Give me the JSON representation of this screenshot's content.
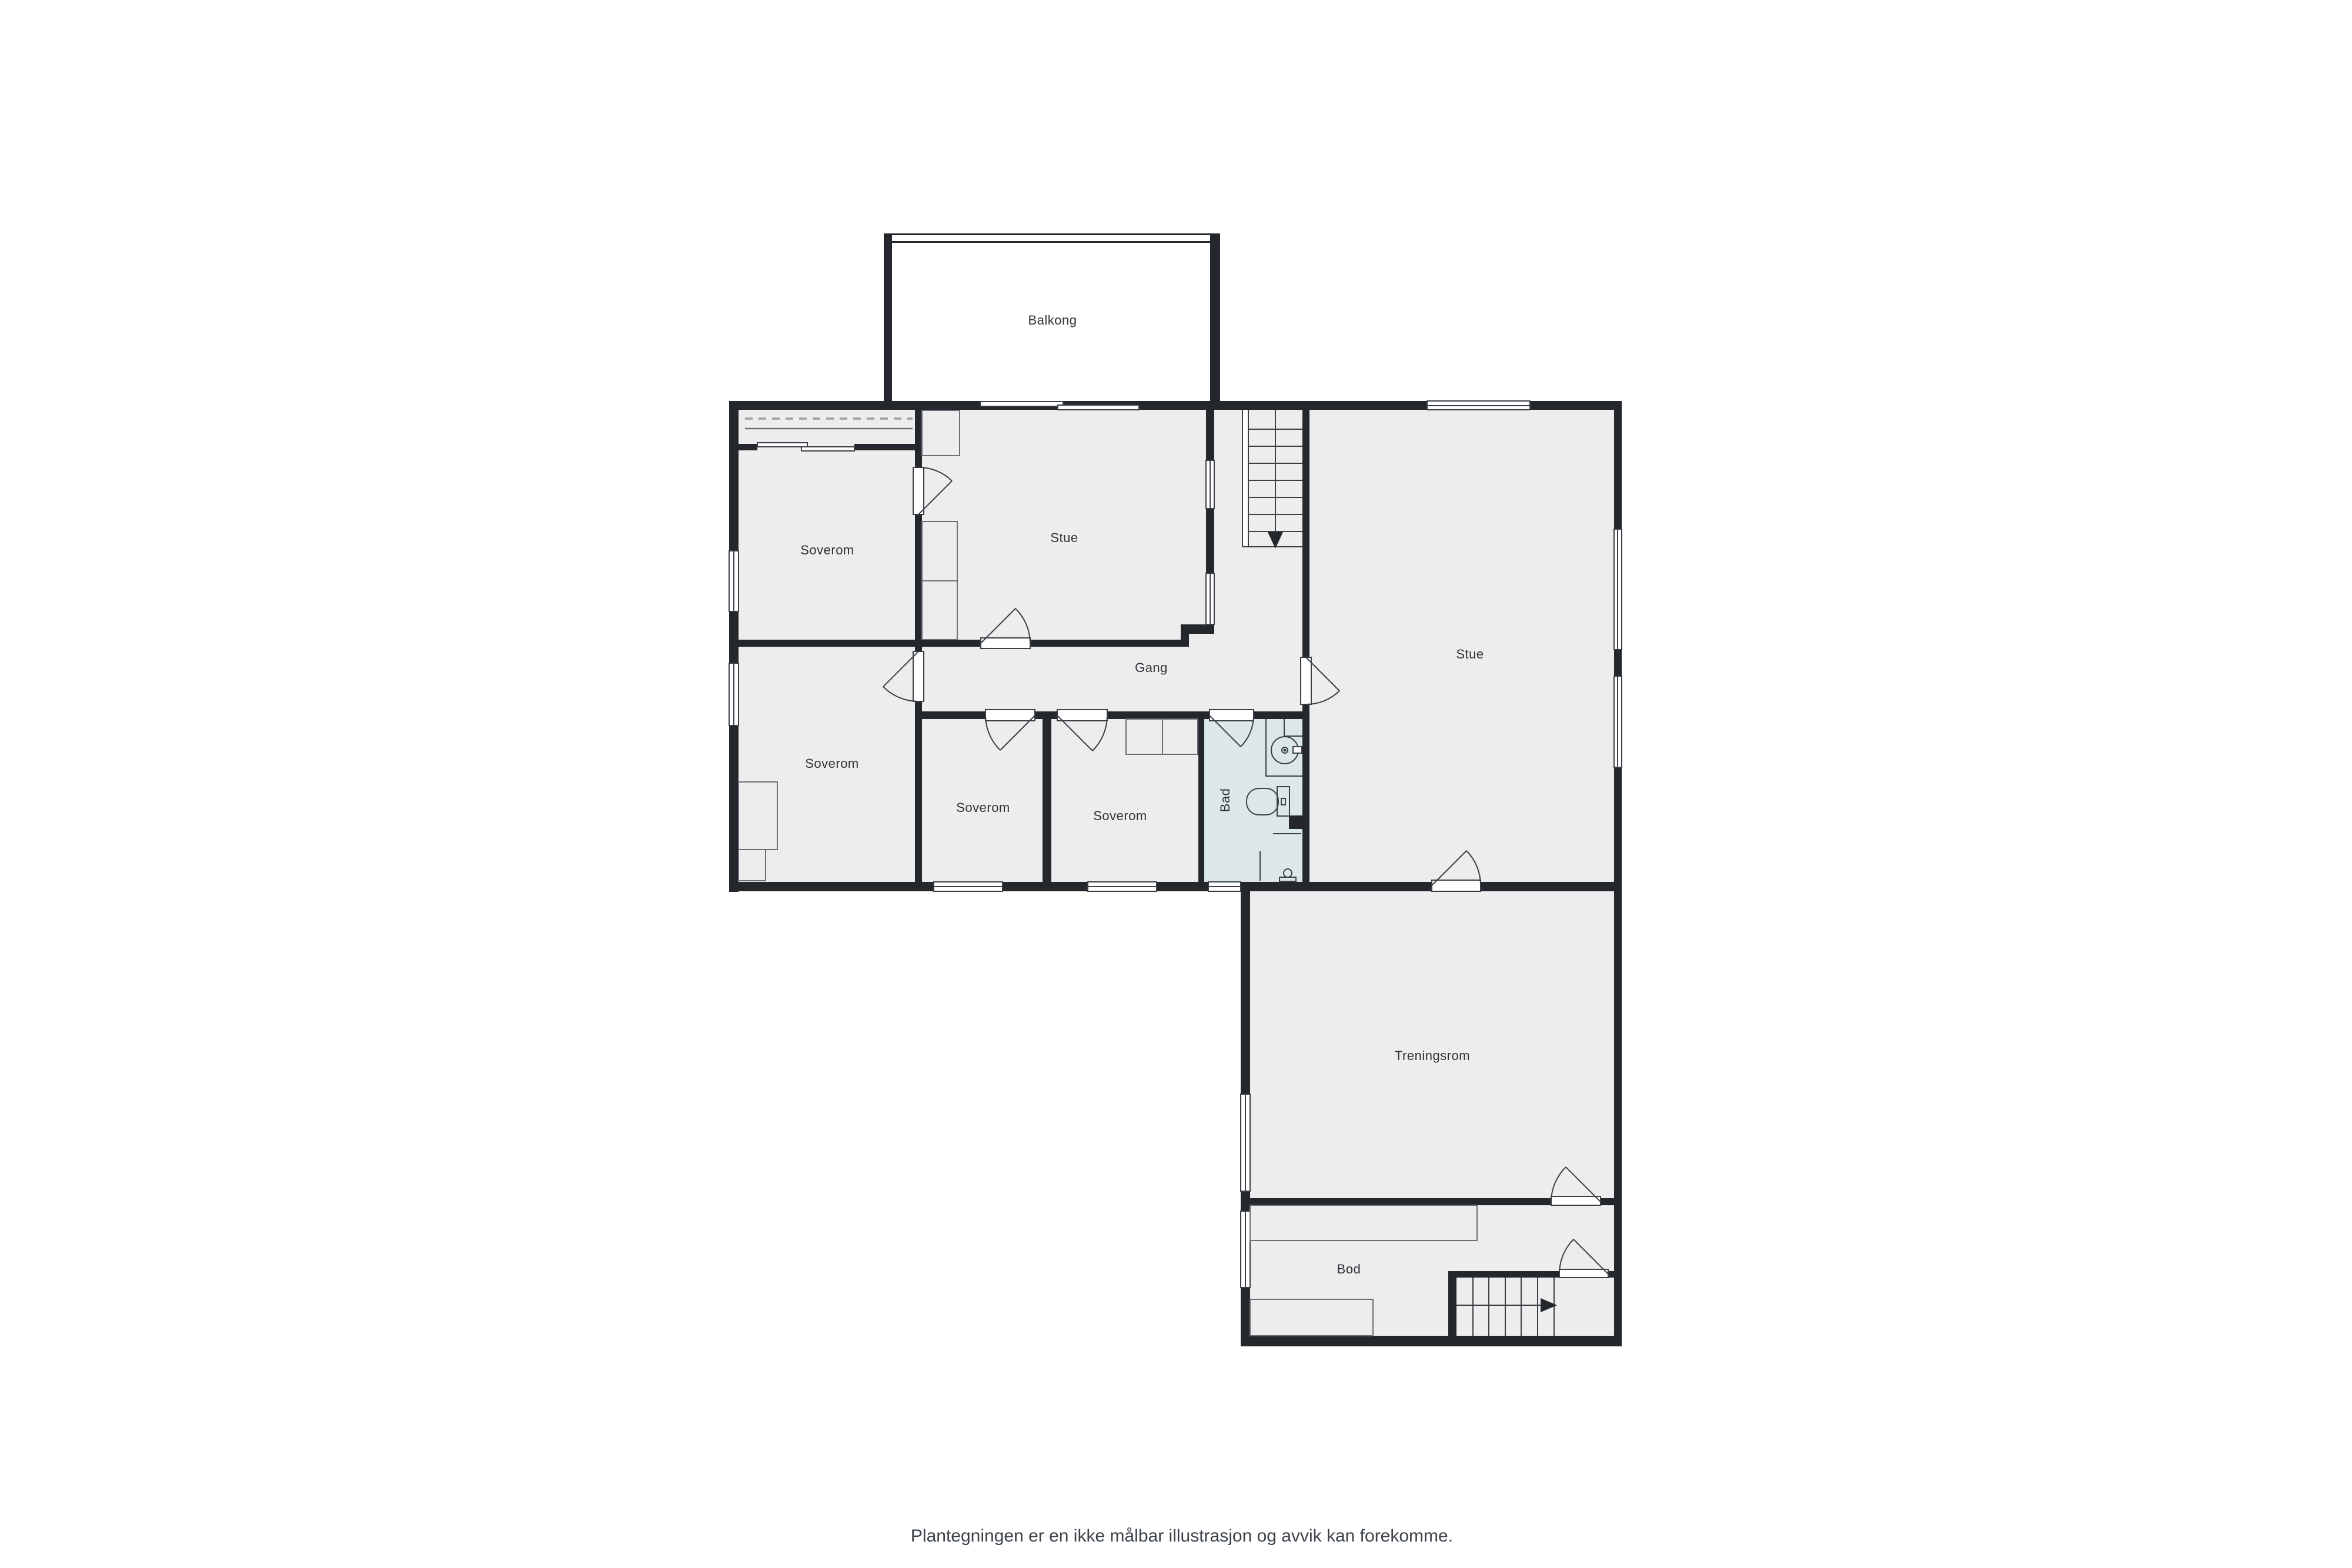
{
  "plan": {
    "rooms": {
      "balkong": {
        "label": "Balkong"
      },
      "stue_upper": {
        "label": "Stue"
      },
      "soverom_nw": {
        "label": "Soverom"
      },
      "soverom_w": {
        "label": "Soverom"
      },
      "soverom_mid": {
        "label": "Soverom"
      },
      "soverom_e": {
        "label": "Soverom"
      },
      "gang": {
        "label": "Gang"
      },
      "bad": {
        "label": "Bad"
      },
      "stue_right": {
        "label": "Stue"
      },
      "treningsrom": {
        "label": "Treningsrom"
      },
      "bod": {
        "label": "Bod"
      }
    },
    "footer": {
      "disclaimer": "Plantegningen er en ikke målbar illustrasjon og avvik kan forekomme."
    },
    "colors": {
      "wall": "#24272b",
      "floor": "#ededee",
      "bathroom_floor": "#dce8e8",
      "outline": "#3a4046",
      "dashed_wardrobe_line": "#9aa0a4",
      "label_text": "#2e3338",
      "footer_text": "#3c434a",
      "background": "#ffffff"
    }
  }
}
